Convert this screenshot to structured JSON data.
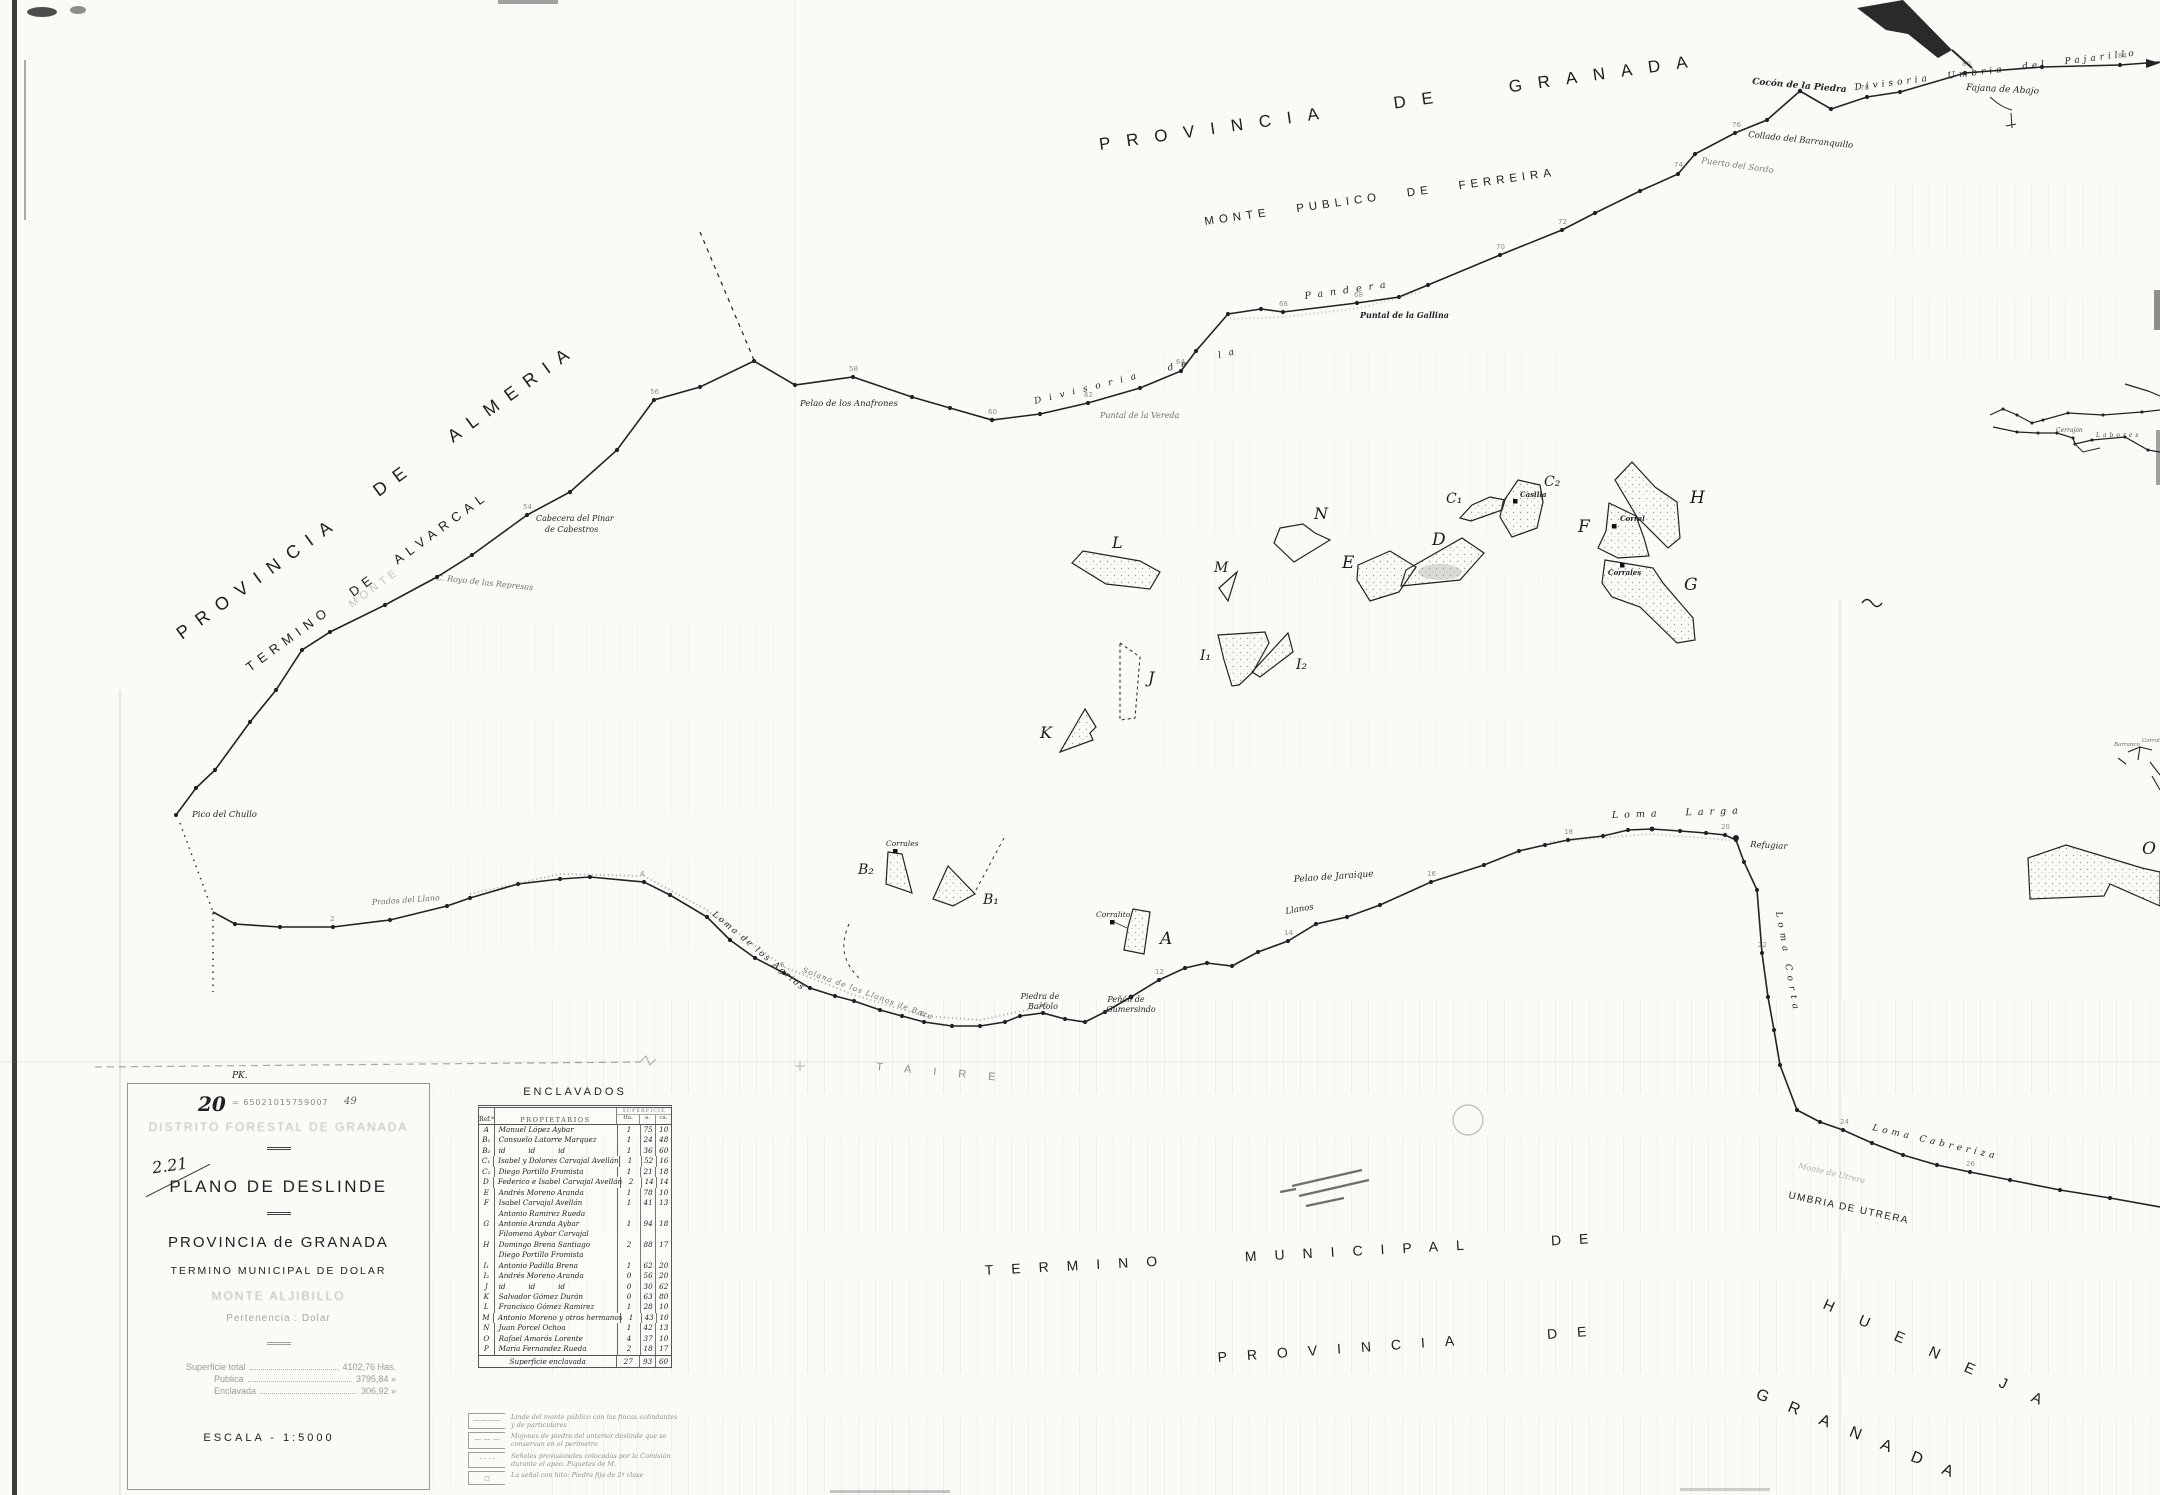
{
  "map_labels": {
    "provincia_granada_top": "PROVINCIA DE GRANADA",
    "monte_publico_ferreira": "MONTE PUBLICO DE FERREIRA",
    "provincia_almeria": "PROVINCIA DE ALMERIA",
    "termino_alvarcal": "TERMINO DE ALVARCAL",
    "monte_stamp_left": "MONTE",
    "divisoria_pajarillo": "Divisoria Umbria del Pajarillo",
    "cocon_piedra": "Cocón de la Piedra",
    "fajana_abajo": "Fajana de Abajo",
    "collado_barranquillo": "Collado del Barranquillo",
    "puerto_sordo": "Puerto del Sordo",
    "divisoria_de_la": "Divisoria de la",
    "pandera": "Pandera",
    "puntal_gallina": "Puntal de la Gallina",
    "pelao_anafrones": "Pelao de los Anafrones",
    "puntal_vereda": "Puntal de la Vereda",
    "cabecera_pinar_1": "Cabecera del Pinar",
    "cabecera_pinar_2": "de Cabestros",
    "royo_represas": "C. Royo de las Represas",
    "pico_chullo": "Pico del Chullo",
    "prados_llano": "Prados del Llano",
    "loma_agrios": "Loma de los Agrios",
    "solana_llanos_baza": "Solana de los Llanos de Baza",
    "piedra_bartolo_1": "Piedra de",
    "piedra_bartolo_2": "Bartolo",
    "penon_gumersindo_1": "Peñón de",
    "penon_gumersindo_2": "Gumersindo",
    "llanos": "Llanos",
    "pelao_jaraique": "Pelao de Jaraique",
    "loma_larga": "Loma  Larga",
    "refugiar": "Refugiar",
    "loma_corta": "Loma Corta",
    "loma_cabreriza": "Loma Cabreriza",
    "monte_utrera_faded": "Monte de Utrera",
    "umbria_utrera": "UMBRIA DE UTRERA",
    "termino_municipal_de": "TERMINO MUNICIPAL DE",
    "hueneja": "HUENEJA",
    "provincia_de_bottom": "PROVINCIA DE",
    "granada_bottom": "GRANADA",
    "taire": "TAIRE",
    "cerrajon": "Cerrajón",
    "labores": "Labores",
    "barranco_small": "Barranco",
    "corrales_small_right": "Corrales",
    "corrales_b2": "Corrales",
    "corralito_a": "Corralito",
    "casilla_c2": "Casilla",
    "corral_f": "Corral",
    "corrales_g": "Corrales",
    "pk": "PK."
  },
  "enclave_letters": {
    "a": "A",
    "b1": "B₁",
    "b2": "B₂",
    "c1": "C₁",
    "c2": "C₂",
    "d": "D",
    "e": "E",
    "f": "F",
    "g": "G",
    "h": "H",
    "i1": "I₁",
    "i2": "I₂",
    "j": "J",
    "k": "K",
    "l": "L",
    "m": "M",
    "n": "N",
    "o": "O"
  },
  "vertex_numbers": [
    "84",
    "80",
    "78",
    "76",
    "74",
    "72",
    "70",
    "68",
    "66",
    "64",
    "62",
    "60",
    "58",
    "56",
    "54",
    "2",
    "4",
    "6",
    "8",
    "10",
    "12",
    "14",
    "16",
    "18",
    "20",
    "22",
    "24",
    "26"
  ],
  "title_block": {
    "pk": "PK.",
    "number": "20",
    "serial": "= 65021015759007",
    "number2": "49",
    "stamp": "DISTRITO FORESTAL DE GRANADA",
    "annotation": "2.21",
    "title": "PLANO DE DESLINDE",
    "province": "PROVINCIA de GRANADA",
    "municipality": "TERMINO MUNICIPAL DE DOLAR",
    "monte": "MONTE ALJIBILLO",
    "pertenencia": "Pertenencia : Dolar",
    "superficie": {
      "total_label": "Superficie total",
      "total_value": "4102,76 Has.",
      "publica_label": "Publica",
      "publica_value": "3795,84  »",
      "enclavada_label": "Enclavada",
      "enclavada_value": "306,92  »"
    },
    "escala": "ESCALA - 1:5000"
  },
  "enclavados": {
    "title": "ENCLAVADOS",
    "headers": {
      "ref": "Ref.ª",
      "owners": "PROPIETARIOS",
      "sup": "SUPERFICIE",
      "ha": "Ha.",
      "a": "a.",
      "ca": "ca."
    },
    "rows": [
      {
        "ref": "A",
        "name": "Manuel López Aybar",
        "name2": "",
        "ha": "1",
        "a": "75",
        "ca": "10"
      },
      {
        "ref": "B₁",
        "name": "Consuelo Latorre Marquez",
        "name2": "",
        "ha": "1",
        "a": "24",
        "ca": "48"
      },
      {
        "ref": "B₂",
        "name": "id          id          id",
        "name2": "",
        "ha": "1",
        "a": "36",
        "ca": "60"
      },
      {
        "ref": "C₁",
        "name": "Isabel y Dolores Carvajal Avellán",
        "name2": "",
        "ha": "1",
        "a": "52",
        "ca": "16"
      },
      {
        "ref": "C₂",
        "name": "Diego Portillo Fromista",
        "name2": "",
        "ha": "1",
        "a": "21",
        "ca": "18"
      },
      {
        "ref": "D",
        "name": "Federico e Isabel Carvajal Avellán",
        "name2": "",
        "ha": "2",
        "a": "14",
        "ca": "14"
      },
      {
        "ref": "E",
        "name": "Andrés Moreno Aranda",
        "name2": "",
        "ha": "1",
        "a": "78",
        "ca": "10"
      },
      {
        "ref": "F",
        "name": "Isabel Carvajal Avellán",
        "name2": "Antonio Ramirez Rueda",
        "ha": "1",
        "a": "41",
        "ca": "13"
      },
      {
        "ref": "G",
        "name": "Antonio Aranda Aybar",
        "name2": "Filomena Aybar Carvajal",
        "ha": "1",
        "a": "94",
        "ca": "18"
      },
      {
        "ref": "H",
        "name": "Domingo Brena Santiago",
        "name2": "Diego Portillo Fromista",
        "ha": "2",
        "a": "88",
        "ca": "17"
      },
      {
        "ref": "I₁",
        "name": "Antonio Padilla Brena",
        "name2": "",
        "ha": "1",
        "a": "62",
        "ca": "20"
      },
      {
        "ref": "I₂",
        "name": "Andrés Moreno Aranda",
        "name2": "",
        "ha": "0",
        "a": "56",
        "ca": "20"
      },
      {
        "ref": "J",
        "name": "id          id          id",
        "name2": "",
        "ha": "0",
        "a": "30",
        "ca": "62"
      },
      {
        "ref": "K",
        "name": "Salvador Gómez Durán",
        "name2": "",
        "ha": "0",
        "a": "63",
        "ca": "80"
      },
      {
        "ref": "L",
        "name": "Francisco Gómez Ramirez",
        "name2": "",
        "ha": "1",
        "a": "28",
        "ca": "10"
      },
      {
        "ref": "M",
        "name": "Antonio Moreno y otros hermanos",
        "name2": "",
        "ha": "1",
        "a": "43",
        "ca": "10"
      },
      {
        "ref": "N",
        "name": "Juan Porcel Ochoa",
        "name2": "",
        "ha": "1",
        "a": "42",
        "ca": "13"
      },
      {
        "ref": "O",
        "name": "Rafael Amorós Lorente",
        "name2": "",
        "ha": "4",
        "a": "37",
        "ca": "10"
      },
      {
        "ref": "P",
        "name": "Maria Fernandez Rueda",
        "name2": "",
        "ha": "2",
        "a": "18",
        "ca": "17"
      }
    ],
    "footer": {
      "label": "Superficie enclavada",
      "ha": "27",
      "a": "93",
      "ca": "60"
    }
  },
  "legend": {
    "items": [
      {
        "sym": "————",
        "l1": "Linde del monte público con las fincas colindantes",
        "l2": "y de particulares"
      },
      {
        "sym": "— — —",
        "l1": "Mojones de piedra del anterior deslinde que se",
        "l2": "conservan en el perímetro"
      },
      {
        "sym": "· · · ·",
        "l1": "Señales provisionales colocadas por la Comisión",
        "l2": "durante el apeo. Piquetes de M."
      },
      {
        "sym": "◻",
        "l1": "La señal con hito: Piedra fija de 2ª clase",
        "l2": ""
      }
    ]
  }
}
